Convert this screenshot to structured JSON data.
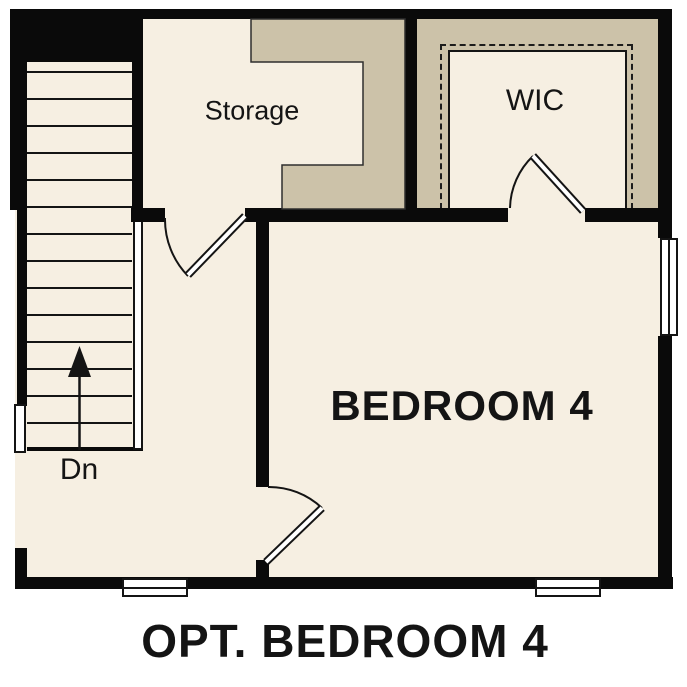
{
  "page_title": "OPT. BEDROOM 4",
  "colors": {
    "floor": "#f6efe2",
    "shaded": "#ccc2a9",
    "wall": "#0a0a0a",
    "ink": "#141414"
  },
  "rooms": {
    "storage": {
      "label": "Storage"
    },
    "wic": {
      "label": "WIC"
    },
    "bedroom4": {
      "label": "BEDROOM 4"
    }
  },
  "stairs": {
    "down_label": "Dn"
  },
  "footer": {
    "title": "OPT. BEDROOM 4"
  }
}
